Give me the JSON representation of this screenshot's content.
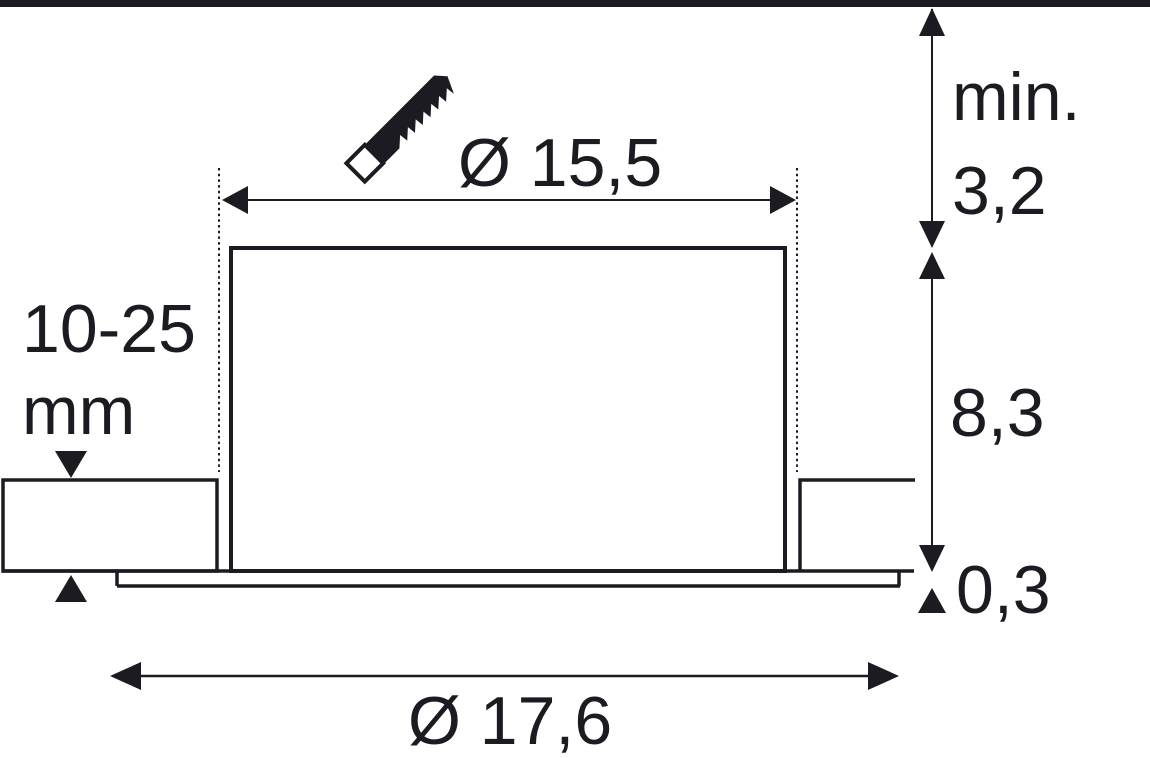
{
  "diagram": {
    "ink_color": "#1c1b22",
    "background_color": "#ffffff",
    "dimensions": {
      "cutout_diameter": "Ø 15,5",
      "outer_diameter": "Ø 17,6",
      "min_recess_prefix": "min.",
      "min_recess_value": "3,2",
      "housing_height": "8,3",
      "trim_thickness": "0,3",
      "ceiling_thickness_range": "10-25",
      "ceiling_thickness_unit": "mm"
    },
    "icons": {
      "saw": "saw-blade-icon"
    }
  }
}
